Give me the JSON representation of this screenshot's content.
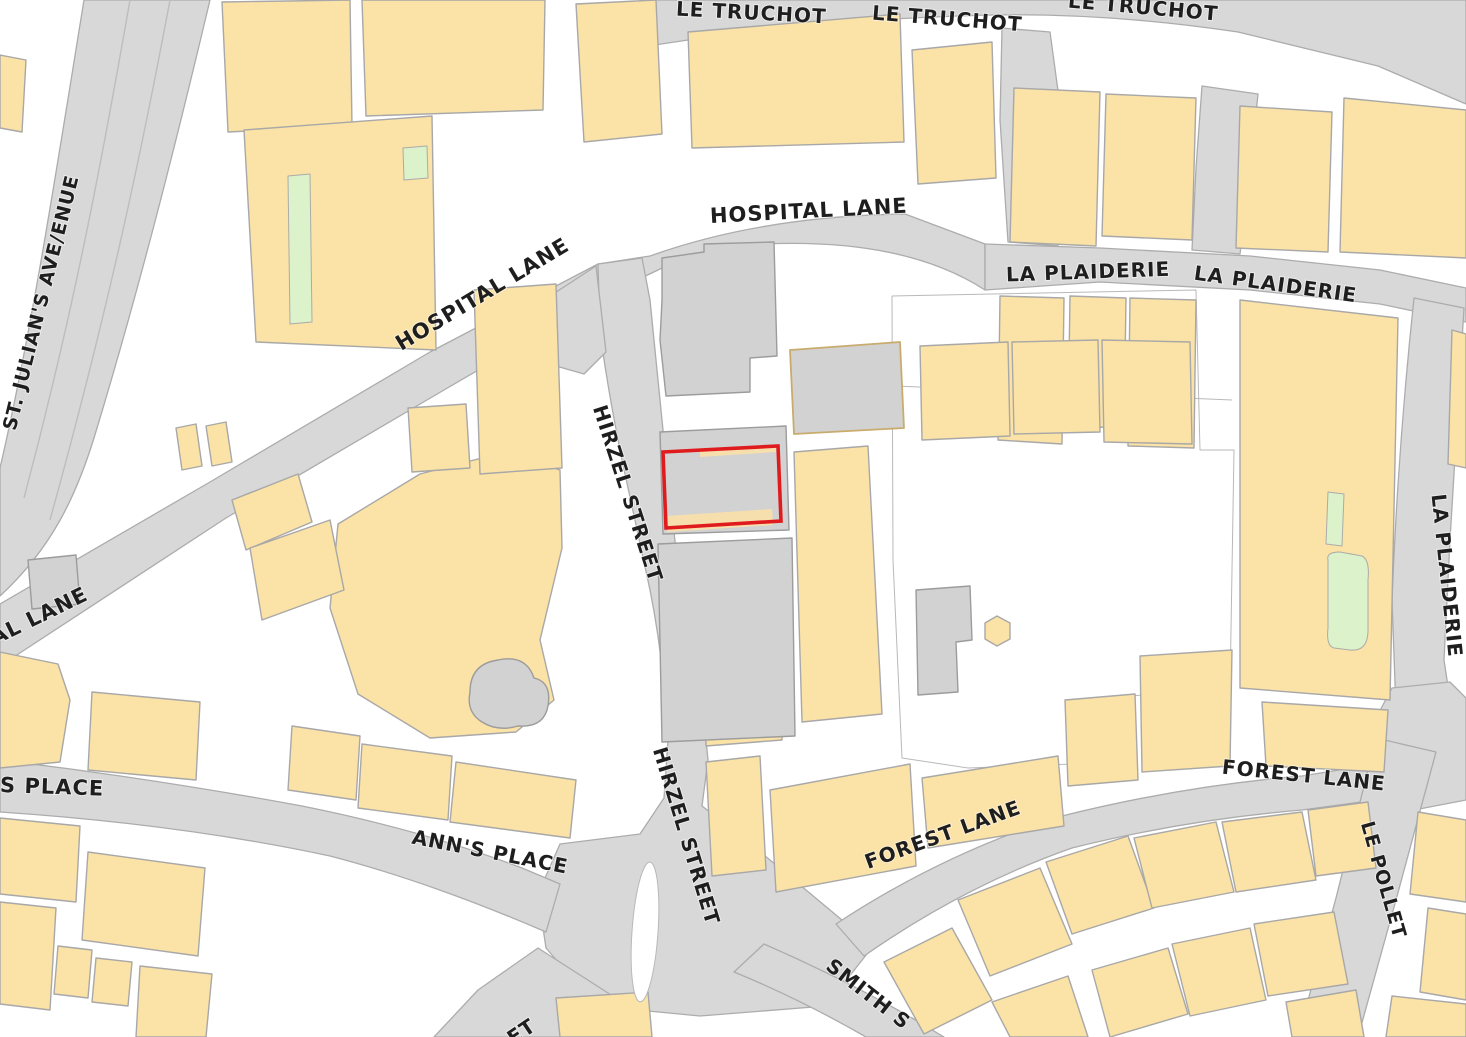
{
  "canvas": {
    "width": 1466,
    "height": 1037,
    "background": "#FFFFFF"
  },
  "palette": {
    "road_fill": "#D8D8D8",
    "road_edge": "#ACACAC",
    "building_fill": "#FBE2A6",
    "building_edge": "#A8A8A8",
    "parcel_gray": "#D2D2D2",
    "green_fill": "#DCF2CA",
    "label_color": "#1E1E1E",
    "highlight_red": "#E01B1E"
  },
  "map": {
    "roads": [
      {
        "name": "le-truchot",
        "d": "M 640,0 L 1466,0 L 1466,104 L 1378,66 L 1238,32 Q 1090,10 958,16 Q 798,22 688,40 L 648,46 Z"
      },
      {
        "name": "st-julians-avenue",
        "d": "M 84,0 L 210,0 C 172,160 136,300 94,438 C 76,496 52,548 0,596 L 0,468 C 32,330 58,160 84,0 Z"
      },
      {
        "name": "hospital-lane",
        "d": "M 0,604 L 210,482 L 430,352 L 598,264 L 650,256 Q 762,216 905,214 L 985,244 L 985,290 Q 905,238 764,244 Q 696,250 658,270 L 612,292 L 444,390 L 226,518 L 0,666 Z"
      },
      {
        "name": "hirzel-street",
        "d": "M 598,264 L 642,258 L 650,300 Q 656,360 664,440 L 670,500 Q 678,570 690,640 L 702,700 L 708,760 L 702,806 L 746,840 L 842,920 L 870,950 L 826,1006 L 700,1016 L 596,1006 L 546,948 L 538,894 L 560,844 L 640,834 L 664,798 L 668,740 Q 664,660 650,590 L 622,460 Q 606,380 600,330 Z"
      },
      {
        "name": "hirzel-apron",
        "d": "M 544,300 L 596,266 L 606,352 L 584,374 L 556,366 Z"
      },
      {
        "name": "anns-place",
        "d": "M 0,760 Q 150,778 302,806 Q 422,830 522,868 L 560,884 L 546,932 Q 430,882 330,856 Q 180,824 0,812 Z"
      },
      {
        "name": "south-stub",
        "d": "M 538,948 L 622,1002 L 574,1037 L 434,1037 L 478,990 Z"
      },
      {
        "name": "forest-lane",
        "d": "M 836,924 Q 942,854 1062,816 Q 1182,786 1302,776 L 1400,760 L 1406,796 L 1302,810 Q 1184,820 1072,848 Q 964,886 864,956 Z"
      },
      {
        "name": "smith-street",
        "d": "M 764,944 Q 842,978 912,1018 L 944,1037 L 866,1037 Q 798,998 734,972 Z"
      },
      {
        "name": "la-plaiderie-upper",
        "d": "M 985,244 L 1100,248 L 1250,256 L 1380,270 L 1466,288 L 1466,322 L 1380,304 L 1250,290 L 1100,282 L 985,290 Z"
      },
      {
        "name": "la-plaiderie-east",
        "d": "M 1414,298 L 1464,308 L 1450,540 L 1444,660 L 1450,700 L 1396,710 L 1392,600 Q 1398,448 1414,298 Z"
      },
      {
        "name": "pollet-junction",
        "d": "M 1392,688 L 1450,682 L 1466,698 L 1466,800 L 1414,810 L 1380,798 L 1364,766 L 1376,718 Z"
      },
      {
        "name": "le-pollet",
        "d": "M 1376,738 L 1436,752 L 1396,900 L 1358,1037 L 1298,1037 L 1336,898 Z"
      },
      {
        "name": "truchot-link-west",
        "d": "M 1002,28 L 1050,32 L 1062,120 L 1058,246 L 1008,242 L 1000,120 Z"
      },
      {
        "name": "truchot-link-east",
        "d": "M 1202,86 L 1258,94 L 1248,190 L 1240,254 L 1192,250 L 1196,168 Z"
      }
    ],
    "lane_lines": [
      "M 130,0 C 102,160 74,310 24,498",
      "M 170,0 C 140,160 108,310 50,520"
    ],
    "white_areas": [
      {
        "name": "central-courtyard",
        "pts": "892,296 1196,290 1200,450 1234,450 1230,690 1128,696 1126,762 968,768 902,758 893,560"
      },
      {
        "name": "courtyard-hole-west",
        "pts": "392,576 458,572 462,650 396,654"
      }
    ],
    "boundary_lines": [
      "M 895,386 L 1232,400"
    ],
    "buildings": [
      "0,55 26,60 22,132 0,128",
      "222,2 350,0 352,126 228,132",
      "244,130 432,116 436,350 256,342",
      "362,0 545,0 543,110 366,116",
      "576,4 656,0 662,134 584,142",
      "688,32 900,14 904,142 692,148",
      "912,50 992,42 996,178 918,184",
      "1014,88 1100,92 1096,246 1010,242",
      "1106,94 1196,98 1192,240 1102,236",
      "1240,106 1332,112 1328,252 1236,248",
      "1344,98 1466,110 1466,258 1340,252",
      "1000,296 1064,298 1062,444 998,440",
      "1070,296 1126,298 1124,428 1068,426",
      "1130,298 1196,300 1194,448 1128,446",
      "920,346 1008,342 1010,436 922,440",
      "1012,342 1098,340 1100,432 1014,434",
      "1102,340 1190,342 1192,444 1104,442",
      "794,452 868,446 882,714 802,722",
      "703,646 780,640 782,740 706,746",
      "997,616 1010,623 1010,639 997,646 985,639 985,623",
      "1240,300 1398,318 1390,700 1240,688",
      "1262,702 1388,710 1384,772 1266,766",
      "1452,330 1466,334 1466,468 1448,464",
      "1065,700 1135,694 1138,780 1068,786",
      "1140,656 1232,650 1230,766 1142,772",
      "338,524 420,474 505,452 560,470 562,548 540,640 554,700 516,732 430,738 358,694 330,608",
      "474,290 556,284 562,468 480,474",
      "408,408 466,404 470,468 412,472",
      "176,428 196,424 202,466 182,470",
      "206,426 226,422 232,462 212,466",
      "232,500 298,474 312,522 246,550",
      "250,548 330,520 344,590 262,620",
      "0,652 58,664 70,700 60,762 0,768",
      "92,692 200,702 196,780 88,770",
      "292,726 360,736 356,800 288,790",
      "362,744 452,756 448,820 358,808",
      "456,762 576,780 570,838 450,822",
      "0,818 80,826 76,902 0,894",
      "88,852 205,868 198,956 82,940",
      "58,946 92,950 88,998 54,994",
      "96,958 132,962 128,1006 92,1002",
      "0,902 56,908 50,1010 0,1004",
      "140,966 212,974 206,1037 136,1037",
      "556,998 648,992 652,1037 560,1037",
      "706,762 760,756 766,870 712,876",
      "770,790 910,764 916,866 776,892",
      "922,778 1058,756 1064,826 928,848",
      "884,962 952,928 992,1000 924,1034",
      "958,900 1040,868 1072,944 990,976",
      "1046,862 1128,836 1154,908 1072,934",
      "1134,838 1216,822 1234,892 1152,908",
      "1222,822 1302,812 1316,880 1236,892",
      "1308,810 1368,802 1376,868 1316,876",
      "992,1002 1068,976 1088,1037 1010,1037",
      "1092,970 1168,948 1188,1014 1110,1037",
      "1172,944 1250,928 1266,1000 1190,1016",
      "1254,924 1334,912 1348,984 1268,996",
      "1286,1002 1356,990 1364,1037 1292,1037",
      "1418,812 1466,820 1466,902 1410,894",
      "1428,908 1466,914 1466,1000 1420,992",
      "1392,996 1466,1004 1466,1037 1386,1037"
    ],
    "gray_parcels": [
      {
        "name": "parking-parcel-north",
        "pts": "662,300 662,258 704,252 704,244 774,242 777,356 750,358 750,392 666,396 660,340"
      },
      {
        "name": "parcel-tan-edge",
        "pts": "790,350 900,342 904,428 794,434",
        "tan": true
      },
      {
        "name": "highlighted-plot-building",
        "pts": "660,432 786,426 789,530 663,534"
      },
      {
        "name": "parcel-south-of-plot",
        "pts": "658,544 792,538 795,736 662,742"
      },
      {
        "name": "l-shaped-building",
        "pts": "916,590 970,586 972,640 956,642 958,692 918,695"
      },
      {
        "name": "small-gray-house-west",
        "pts": "28,560 76,555 80,604 32,609"
      }
    ],
    "gray_blobs": [
      {
        "name": "gray-cloud-building",
        "d": "M 470,692 Q 470,664 498,660 Q 526,654 534,678 Q 552,682 548,706 Q 544,728 518,726 Q 498,732 482,722 Q 466,712 470,692 Z"
      }
    ],
    "tan_slivers": [
      "700,450 776,445 776,452 700,457",
      "666,516 772,509 773,525 667,532"
    ],
    "greens": [
      {
        "pts": "288,176 310,174 312,322 290,324"
      },
      {
        "pts": "403,148 427,146 428,178 404,180"
      },
      {
        "pts": "1328,492 1344,494 1342,546 1326,544"
      },
      {
        "d": "M 1328,560 Q 1326,552 1340,552 L 1362,556 Q 1370,560 1368,580 L 1368,630 Q 1368,652 1350,650 L 1334,648 Q 1326,646 1328,628 Z"
      }
    ],
    "traffic_island": {
      "cx": 645,
      "cy": 932,
      "rx": 13,
      "ry": 70,
      "rotate": 4
    },
    "highlighted_plot": {
      "pts": "663,452 778,446 781,521 666,528",
      "color": "#E01B1E"
    },
    "labels": [
      {
        "t": "LE TRUCHOT",
        "x": 676,
        "y": 10,
        "r": 3,
        "s": 20
      },
      {
        "t": "LE TRUCHOT",
        "x": 872,
        "y": 14,
        "r": 4.5,
        "s": 20
      },
      {
        "t": "LE TRUCHOT",
        "x": 1068,
        "y": 2,
        "r": 5,
        "s": 20
      },
      {
        "t": "HOSPITAL LANE",
        "x": 710,
        "y": 217,
        "r": -3,
        "s": 21
      },
      {
        "t": "HOSPITAL LANE",
        "x": 398,
        "y": 346,
        "r": -31,
        "s": 21
      },
      {
        "t": "AL LANE",
        "x": -8,
        "y": 640,
        "r": -26,
        "s": 21
      },
      {
        "t": "LA PLAIDERIE",
        "x": 1006,
        "y": 276,
        "r": -2,
        "s": 20
      },
      {
        "t": "LA PLAIDERIE",
        "x": 1194,
        "y": 274,
        "r": 8,
        "s": 20
      },
      {
        "t": "LA PLAIDERIE",
        "x": 1437,
        "y": 494,
        "r": 84,
        "s": 20
      },
      {
        "t": "HIRZEL STREET",
        "x": 598,
        "y": 406,
        "r": 72,
        "s": 20
      },
      {
        "t": "HIRZEL STREET",
        "x": 658,
        "y": 748,
        "r": 73,
        "s": 20
      },
      {
        "t": "ANN'S PLACE",
        "x": 412,
        "y": 838,
        "r": 11,
        "s": 20
      },
      {
        "t": "S PLACE",
        "x": 0,
        "y": 786,
        "r": 2,
        "s": 21
      },
      {
        "t": "ST. JULIAN'S AVE/ENUE",
        "x": 10,
        "y": 430,
        "r": -76,
        "s": 19
      },
      {
        "t": "FOREST LANE",
        "x": 866,
        "y": 864,
        "r": -20,
        "s": 20
      },
      {
        "t": "FOREST LANE",
        "x": 1222,
        "y": 768,
        "r": 6,
        "s": 20
      },
      {
        "t": "LE POLLET",
        "x": 1366,
        "y": 822,
        "r": 74,
        "s": 19
      },
      {
        "t": "SMITH S",
        "x": 828,
        "y": 964,
        "r": 38,
        "s": 20
      },
      {
        "t": "ET",
        "x": 510,
        "y": 1041,
        "r": -34,
        "s": 20
      }
    ]
  }
}
